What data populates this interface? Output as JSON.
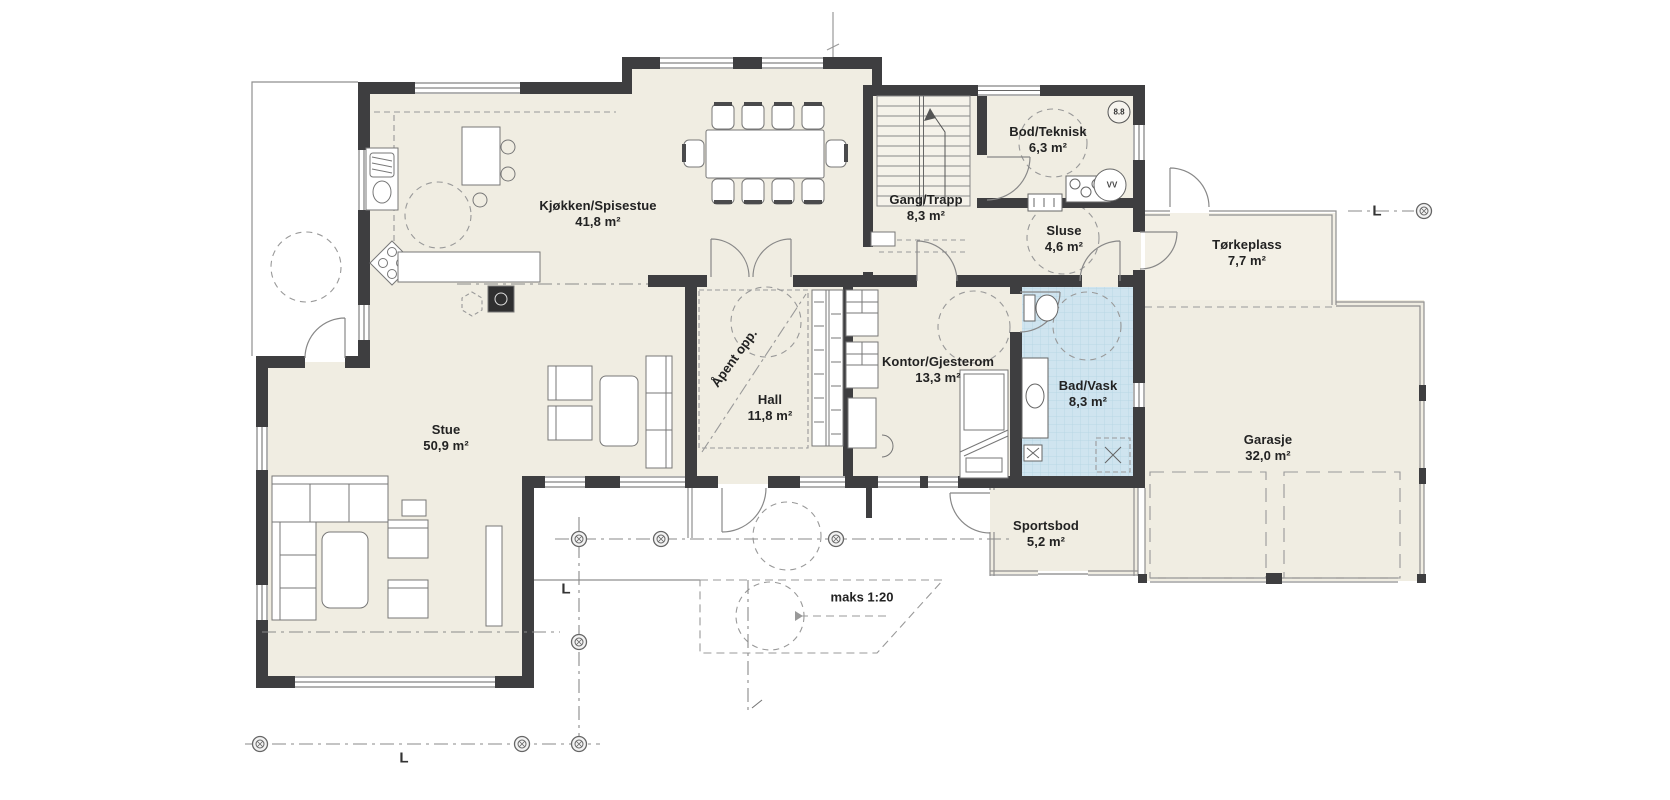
{
  "plan": {
    "rooms": [
      {
        "name": "Kjøkken/Spisestue",
        "area": "41,8 m²"
      },
      {
        "name": "Gang/Trapp",
        "area": "8,3 m²"
      },
      {
        "name": "Bod/Teknisk",
        "area": "6,3 m²"
      },
      {
        "name": "Sluse",
        "area": "4,6 m²"
      },
      {
        "name": "Tørkeplass",
        "area": "7,7 m²"
      },
      {
        "name": "Kontor/Gjesterom",
        "area": "13,3 m²"
      },
      {
        "name": "Hall",
        "area": "11,8 m²"
      },
      {
        "name": "Bad/Vask",
        "area": "8,3 m²"
      },
      {
        "name": "Stue",
        "area": "50,9 m²"
      },
      {
        "name": "Garasje",
        "area": "32,0 m²"
      },
      {
        "name": "Sportsbod",
        "area": "5,2 m²"
      }
    ],
    "annotations": {
      "open_above": "Åpent opp.",
      "ramp_slope": "maks 1:20",
      "section_letter": "L",
      "detail_ref": "8.8",
      "water_heater": "VV"
    },
    "colors": {
      "floor": "#f0ede2",
      "wall": "#3e3e40",
      "bath_tile": "#cfe4ef",
      "thin_line": "#8f8f8f"
    }
  }
}
